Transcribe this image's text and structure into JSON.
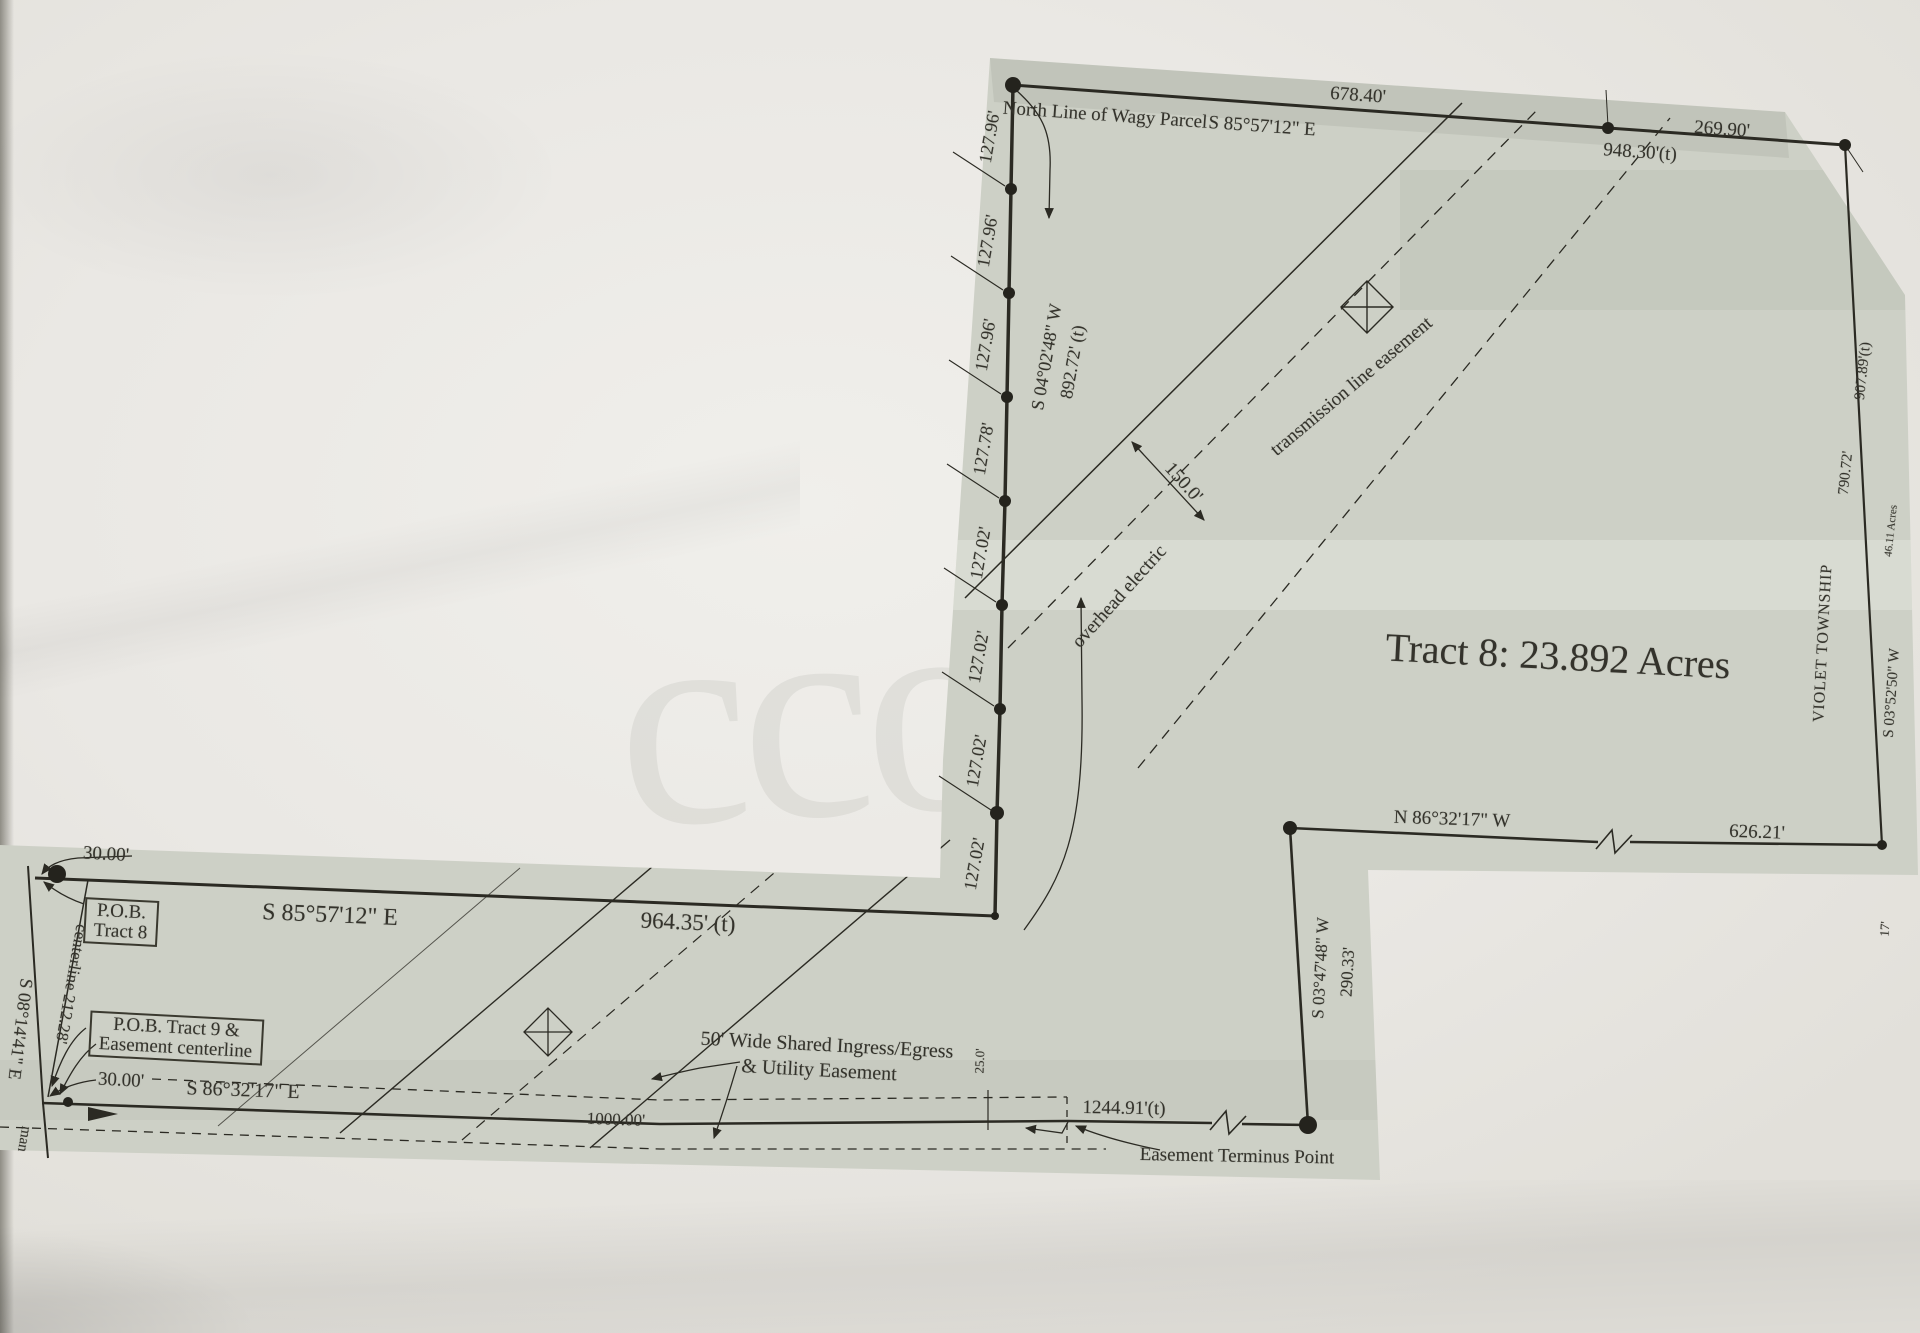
{
  "plat": {
    "watermark": "cco",
    "north": {
      "line_name": "North Line of Wagy Parcel",
      "bearing": "S 85°57'12\" E",
      "seg_west": "678.40'",
      "seg_east": "269.90'",
      "total": "948.30'(t)"
    },
    "west_chain": {
      "segments": [
        "127.96'",
        "127.96'",
        "127.96'",
        "127.78'",
        "127.02'",
        "127.02'",
        "127.02'",
        "127.02'"
      ],
      "bearing": "S 04°02'48\" W",
      "total": "892.72' (t)"
    },
    "transmission": {
      "overhead_label": "overhead electric",
      "width_dim": "150.0'",
      "easement_label": "transmission line easement"
    },
    "tract8_area": "Tract 8: 23.892 Acres",
    "east": {
      "total": "907.89'(t)",
      "segment": "790.72'",
      "adjacent_area": "46.11 Acres",
      "township": "VIOLET TOWNSHIP",
      "bearing": "S 03°52'50\" W",
      "corner_fragment": "17'"
    },
    "south_upper": {
      "bearing": "N 86°32'17\" W",
      "distance": "626.21'"
    },
    "interior": {
      "bearing": "S 03°47'48\" W",
      "distance": "290.33'"
    },
    "strip": {
      "offset_north": "30.00'",
      "pob8": {
        "line1": "P.O.B.",
        "line2": "Tract 8"
      },
      "bearing_north": "S 85°57'12\" E",
      "distance_north": "964.35' (t)",
      "centerline_dim": "centerline 212.28'",
      "west_bearing": "S 08°14'41\" E",
      "edge_fragment": "man",
      "pob9": {
        "line1": "P.O.B. Tract 9 &",
        "line2": "Easement centerline"
      },
      "offset_south": "30.00'",
      "bearing_south": "S 86°32'17\" E",
      "distance_partial": "1000.00'",
      "easement_note_line1": "50' Wide Shared Ingress/Egress",
      "easement_note_line2": "& Utility Easement",
      "half_width": "25.0'",
      "total_south": "1244.91'(t)",
      "terminus": "Easement Terminus Point"
    }
  }
}
